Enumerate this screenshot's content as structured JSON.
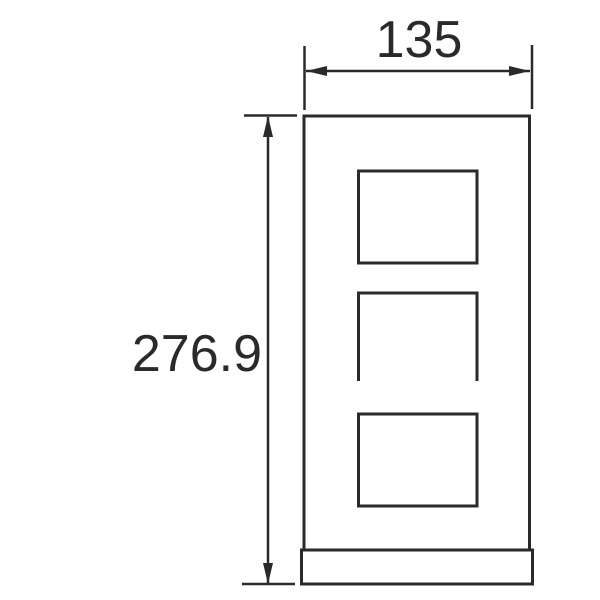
{
  "dimensions": {
    "width": {
      "label": "135"
    },
    "height": {
      "label": "276.9"
    }
  },
  "colors": {
    "line": "#2a2a2a",
    "background": "#ffffff"
  }
}
